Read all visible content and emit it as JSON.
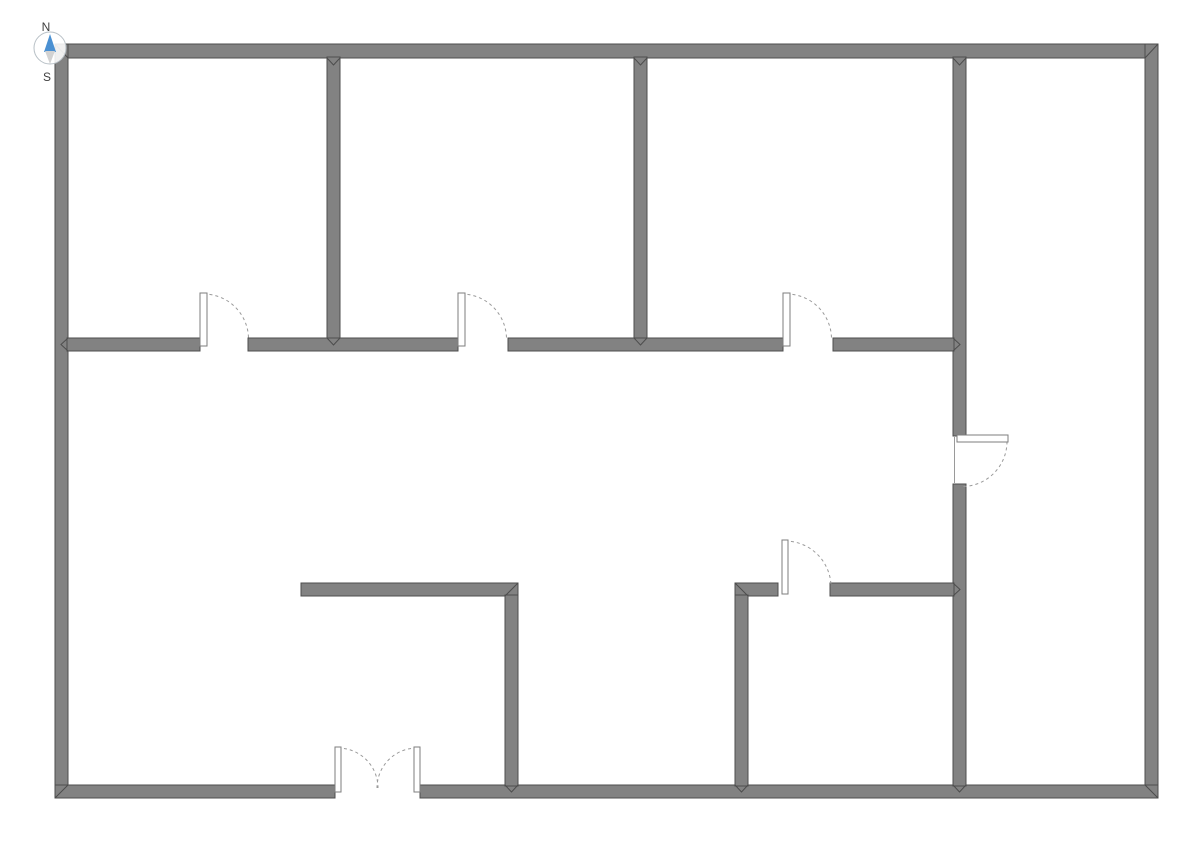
{
  "title": "Floor plan",
  "compass": {
    "north_label": "N",
    "south_label": "S"
  },
  "palette": {
    "background": "#ffffff",
    "wall_fill": "#828282",
    "wall_stroke": "#4d4d4d",
    "door_leaf_fill": "#ffffff",
    "door_leaf_stroke": "#7d7d7d",
    "swing_arc": "#9a9a9a",
    "compass_needle": "#4a90d2",
    "compass_tail": "#d2d2d2",
    "compass_ring": "#b8c0c6"
  },
  "floor_plan": {
    "canvas": {
      "width": 1191,
      "height": 842
    },
    "walls": [
      {
        "id": "outer-top",
        "x": 55,
        "y": 44,
        "w": 1103,
        "h": 14
      },
      {
        "id": "outer-left",
        "x": 55,
        "y": 44,
        "w": 13,
        "h": 754
      },
      {
        "id": "outer-right",
        "x": 1145,
        "y": 44,
        "w": 13,
        "h": 754
      },
      {
        "id": "outer-bottom-west",
        "x": 55,
        "y": 785,
        "w": 280,
        "h": 13
      },
      {
        "id": "outer-bottom-east",
        "x": 420,
        "y": 785,
        "w": 738,
        "h": 13
      },
      {
        "id": "partition-a",
        "x": 327,
        "y": 57,
        "w": 13,
        "h": 282
      },
      {
        "id": "partition-b",
        "x": 634,
        "y": 57,
        "w": 13,
        "h": 282
      },
      {
        "id": "partition-c-upper",
        "x": 953,
        "y": 57,
        "w": 13,
        "h": 379
      },
      {
        "id": "partition-c-lower",
        "x": 953,
        "y": 484,
        "w": 13,
        "h": 302
      },
      {
        "id": "corridor-wall-1",
        "x": 67,
        "y": 338,
        "w": 133,
        "h": 13
      },
      {
        "id": "corridor-wall-2",
        "x": 248,
        "y": 338,
        "w": 210,
        "h": 13
      },
      {
        "id": "corridor-wall-3",
        "x": 508,
        "y": 338,
        "w": 275,
        "h": 13
      },
      {
        "id": "corridor-wall-4",
        "x": 833,
        "y": 338,
        "w": 121,
        "h": 13
      },
      {
        "id": "lower-partition-horiz",
        "x": 301,
        "y": 583,
        "w": 217,
        "h": 13
      },
      {
        "id": "lower-partition-vert",
        "x": 505,
        "y": 595,
        "w": 13,
        "h": 191
      },
      {
        "id": "sw-room-wall-west",
        "x": 735,
        "y": 583,
        "w": 43,
        "h": 13
      },
      {
        "id": "sw-room-wall-east",
        "x": 830,
        "y": 583,
        "w": 124,
        "h": 13
      },
      {
        "id": "sw-room-wall-vert",
        "x": 735,
        "y": 595,
        "w": 13,
        "h": 191
      }
    ],
    "mitres": [
      {
        "id": "corner-nw",
        "points": "55,44 68,58"
      },
      {
        "id": "corner-ne",
        "points": "1158,44 1145,58"
      },
      {
        "id": "corner-se",
        "points": "1158,798 1145,785"
      },
      {
        "id": "corner-sw",
        "points": "55,798 68,785"
      },
      {
        "id": "tjoint-a-top",
        "points": "327,58 333.5,65 340,58"
      },
      {
        "id": "tjoint-b-top",
        "points": "634,58 640.5,65 647,58"
      },
      {
        "id": "tjoint-c-top",
        "points": "953,58 959.5,65 966,58"
      },
      {
        "id": "tjoint-a-bottom",
        "points": "327,338 333.5,345 340,338"
      },
      {
        "id": "tjoint-b-bottom",
        "points": "634,338 640.5,345 647,338"
      },
      {
        "id": "tjoint-corridor-west",
        "points": "68,338 61,344.5 68,351"
      },
      {
        "id": "tjoint-corridor-east",
        "points": "953,338 960,344.5 953,351"
      },
      {
        "id": "corner-lower-partition",
        "points": "518,583 505,596"
      },
      {
        "id": "tjoint-lower-partition-bottom",
        "points": "505,785 511.5,792 518,785"
      },
      {
        "id": "corner-sw-room",
        "points": "735,583 748,596"
      },
      {
        "id": "tjoint-sw-room-east",
        "points": "953,583 960,589.5 953,596"
      },
      {
        "id": "tjoint-sw-room-bottom",
        "points": "735,785 741.5,792 748,785"
      },
      {
        "id": "tjoint-c-bottom",
        "points": "953,785 959.5,792 966,785"
      }
    ],
    "doors": [
      {
        "id": "door-room-1",
        "leaf": {
          "x": 200,
          "y": 293,
          "w": 7,
          "h": 53
        },
        "arc": "M 203.5 294 A 45 45 0 0 1 248.5 339"
      },
      {
        "id": "door-room-2",
        "leaf": {
          "x": 458,
          "y": 293,
          "w": 7,
          "h": 53
        },
        "arc": "M 461.5 294 A 45 45 0 0 1 506.5 339"
      },
      {
        "id": "door-room-3",
        "leaf": {
          "x": 783,
          "y": 293,
          "w": 7,
          "h": 53
        },
        "arc": "M 786.5 294 A 45 45 0 0 1 831.5 339"
      },
      {
        "id": "door-east-corridor",
        "leaf": {
          "x": 957,
          "y": 435,
          "w": 51,
          "h": 7
        },
        "arc": "M 1007 441.5 A 45 45 0 0 1 962 486.5",
        "jamb": {
          "x1": 954.5,
          "y1": 437,
          "x2": 954.5,
          "y2": 483
        }
      },
      {
        "id": "door-sw-room",
        "leaf": {
          "x": 782,
          "y": 540,
          "w": 6,
          "h": 54
        },
        "arc": "M 785 541 A 46 46 0 0 1 831 587"
      },
      {
        "id": "double-door-left",
        "leaf": {
          "x": 335,
          "y": 747,
          "w": 6,
          "h": 45
        },
        "arc": "M 338 748 A 40 40 0 0 1 378 788"
      },
      {
        "id": "double-door-right",
        "leaf": {
          "x": 414,
          "y": 747,
          "w": 6,
          "h": 45
        },
        "arc": "M 417 748 A 40 40 0 0 0 377 788"
      }
    ]
  }
}
